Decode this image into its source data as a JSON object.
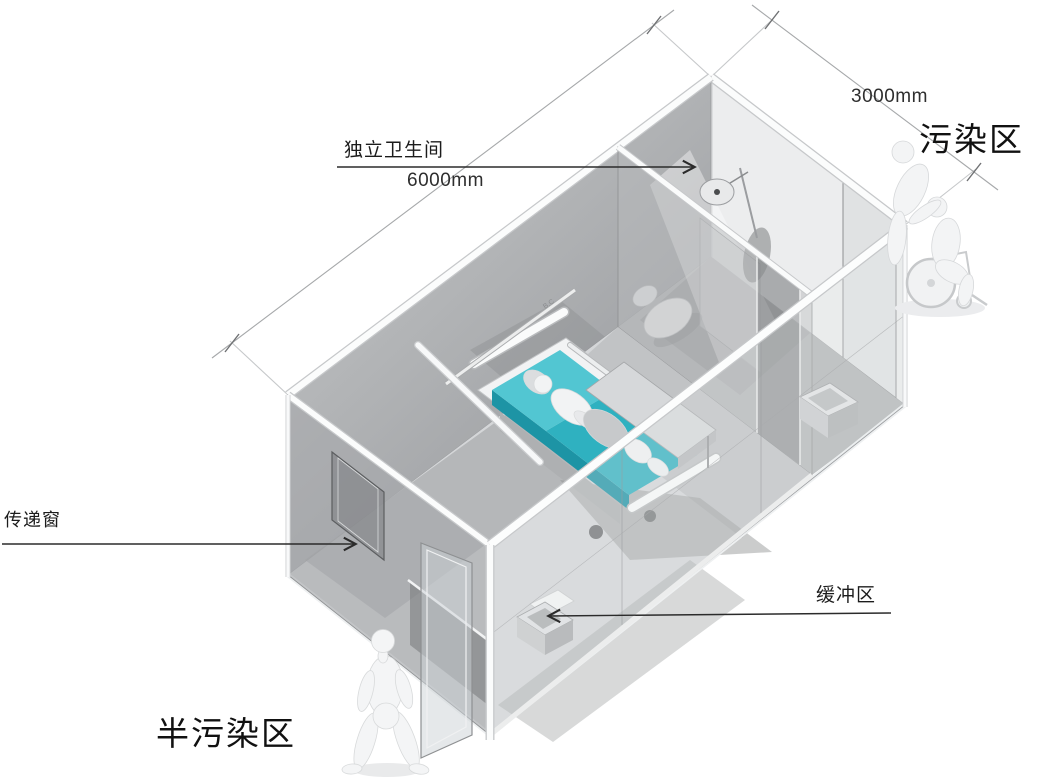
{
  "canvas": {
    "width": 1050,
    "height": 779,
    "background": "#ffffff"
  },
  "annotations": {
    "bathroom": {
      "label": "独立卫生间"
    },
    "transfer_window": {
      "label": "传递窗"
    },
    "buffer_zone": {
      "label": "缓冲区"
    },
    "contaminated_zone": {
      "label": "污染区"
    },
    "semi_contaminated_zone": {
      "label": "半污染区"
    }
  },
  "dimensions": {
    "length": "6000mm",
    "width": "3000mm"
  },
  "scene": {
    "type": "axonometric-isolation-ward-diagram",
    "rail_marking": "B.C",
    "objects": [
      "container-room",
      "hospital-bed",
      "patient",
      "overbed-table",
      "iv-pole",
      "wall-equipment-rail",
      "shower-head",
      "shower-glass",
      "toilet",
      "bathroom-partition",
      "transfer-window",
      "buffer-basin",
      "supply-box",
      "sliding-glass-door",
      "walking-person",
      "wheelchair-patient",
      "caregiver"
    ],
    "colors": {
      "bed_mattress": "#35b6c4",
      "bed_mattress_dark": "#1d94a5",
      "bed_mattress_light": "#52c6d2",
      "wall": "#b3b5b7",
      "floor": "#d4d6d8",
      "line": "#9b9da0",
      "arrow": "#2b2b2b",
      "text": "#1c1c1c",
      "figure": "#f3f4f5"
    }
  }
}
